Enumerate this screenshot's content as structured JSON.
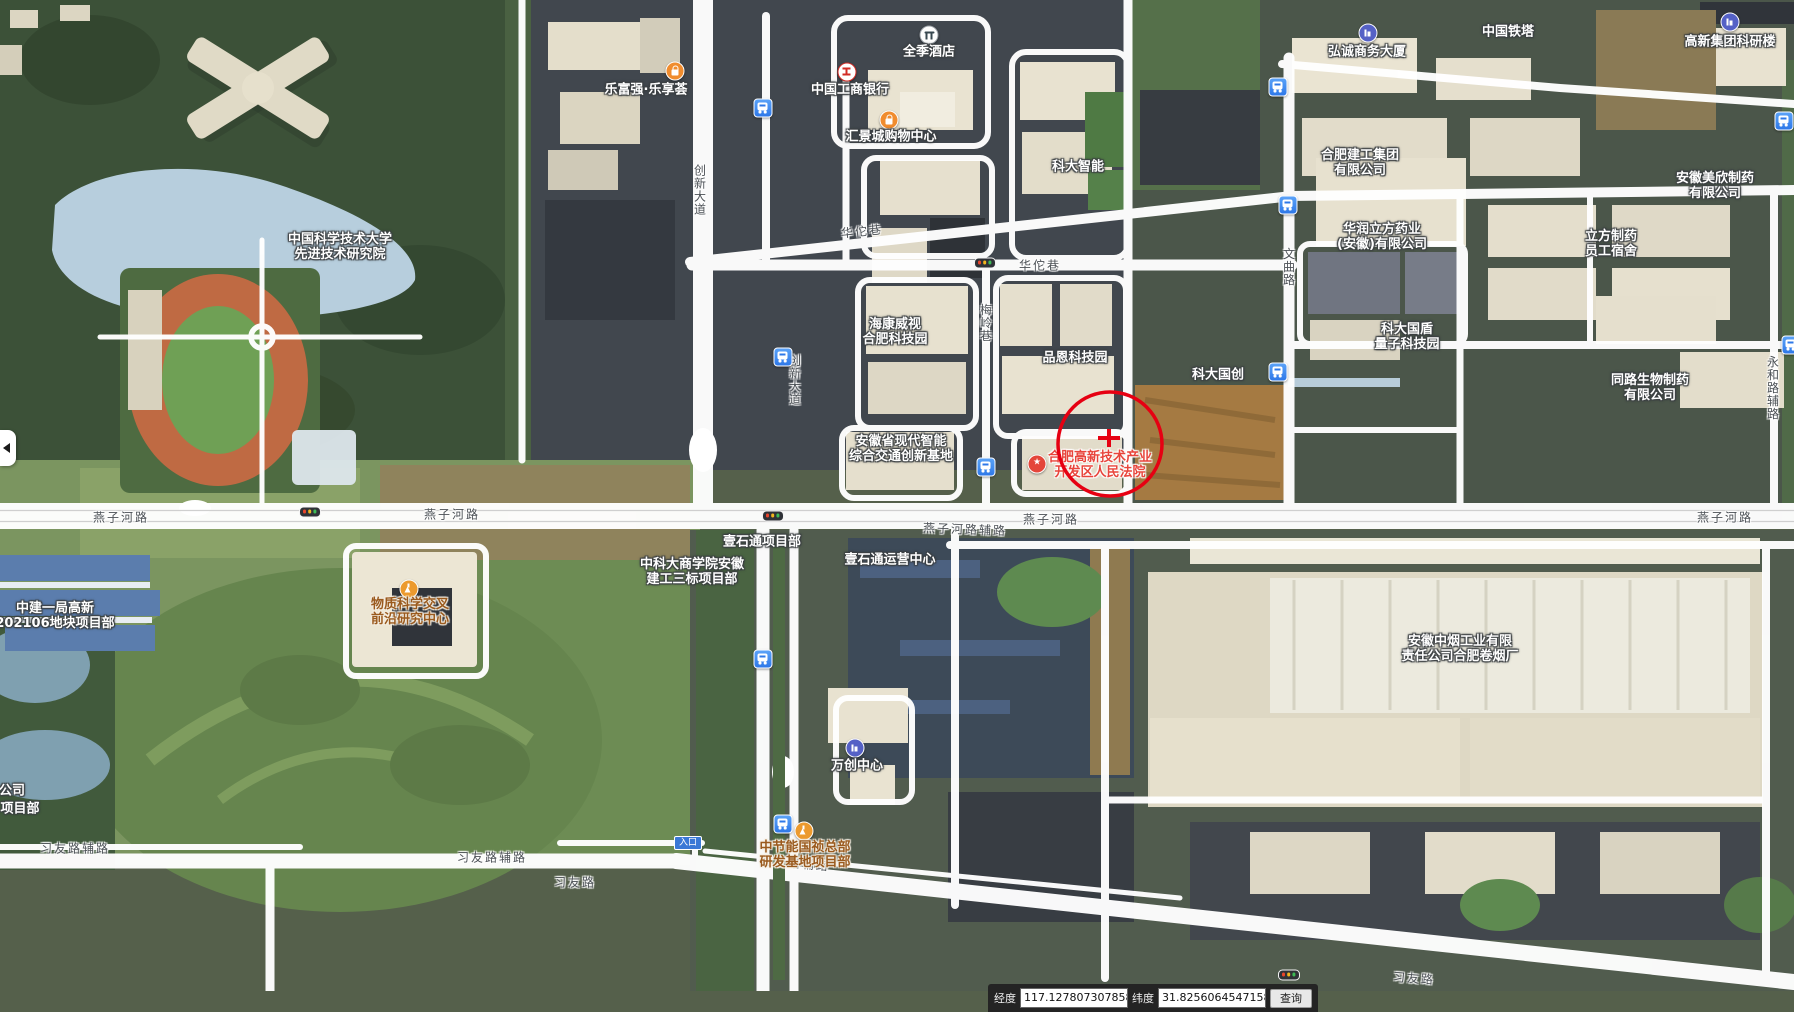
{
  "colors": {
    "road_white": "#ffffff",
    "marker_red": "#e60012",
    "poi_red_text": "#e8453c",
    "poi_brown_text": "#9a5a1e",
    "bus_icon_blue": "#2e78e8",
    "water_blue": "#b7cedd"
  },
  "pois": [
    {
      "l1": "中国科学技术大学",
      "l2": "先进技术研究院",
      "x": 340,
      "y": 247
    },
    {
      "l1": "乐富强·乐享荟",
      "x": 646,
      "y": 90
    },
    {
      "l1": "全季酒店",
      "x": 929,
      "y": 52
    },
    {
      "l1": "中国工商银行",
      "x": 850,
      "y": 90
    },
    {
      "l1": "汇景城购物中心",
      "x": 891,
      "y": 137
    },
    {
      "l1": "科大智能",
      "x": 1078,
      "y": 167
    },
    {
      "l1": "弘诚商务大厦",
      "x": 1367,
      "y": 52
    },
    {
      "l1": "中国铁塔",
      "x": 1508,
      "y": 32
    },
    {
      "l1": "高新集团科研楼",
      "x": 1730,
      "y": 42
    },
    {
      "l1": "合肥建工集团",
      "l2": "有限公司",
      "x": 1360,
      "y": 163
    },
    {
      "l1": "华润立方药业",
      "l2": "(安徽)有限公司",
      "x": 1382,
      "y": 237
    },
    {
      "l1": "安徽美欣制药",
      "l2": "有限公司",
      "x": 1715,
      "y": 186
    },
    {
      "l1": "立方制药",
      "l2": "员工宿舍",
      "x": 1611,
      "y": 244
    },
    {
      "l1": "海康威视",
      "l2": "合肥科技园",
      "x": 895,
      "y": 332
    },
    {
      "l1": "品恩科技园",
      "x": 1075,
      "y": 358
    },
    {
      "l1": "科大国创",
      "x": 1218,
      "y": 375
    },
    {
      "l1": "科大国盾",
      "l2": "量子科技园",
      "x": 1407,
      "y": 337
    },
    {
      "l1": "同路生物制药",
      "l2": "有限公司",
      "x": 1650,
      "y": 388
    },
    {
      "l1": "安徽省现代智能",
      "l2": "综合交通创新基地",
      "x": 901,
      "y": 449
    },
    {
      "l1": "合肥高新技术产业",
      "l2": "开发区人民法院",
      "x": 1100,
      "y": 465,
      "cls": "red"
    },
    {
      "l1": "物质科学交叉",
      "l2": "前沿研究中心",
      "x": 410,
      "y": 612,
      "cls": "brown"
    },
    {
      "l1": "中建一局高新",
      "l2": "202106地块项目部",
      "x": 55,
      "y": 616
    },
    {
      "l1": "中科大商学院安徽",
      "l2": "建工三标项目部",
      "x": 692,
      "y": 572
    },
    {
      "l1": "壹石通项目部",
      "x": 762,
      "y": 542
    },
    {
      "l1": "壹石通运营中心",
      "x": 890,
      "y": 560
    },
    {
      "l1": "万创中心",
      "x": 857,
      "y": 766
    },
    {
      "l1": "中节能国祯总部",
      "l2": "研发基地项目部",
      "x": 805,
      "y": 855,
      "cls": "brown"
    },
    {
      "l1": "安徽中烟工业有限",
      "l2": "责任公司合肥卷烟厂",
      "x": 1460,
      "y": 649
    },
    {
      "l1": "公司",
      "x": 12,
      "y": 791
    },
    {
      "l1": "项目部",
      "x": 20,
      "y": 809
    }
  ],
  "poi_icons": [
    {
      "type": "shopping-bag",
      "x": 675,
      "y": 71
    },
    {
      "type": "hotel",
      "x": 929,
      "y": 35
    },
    {
      "type": "bank",
      "x": 847,
      "y": 72
    },
    {
      "type": "shopping-bag",
      "x": 889,
      "y": 120
    },
    {
      "type": "building",
      "x": 1368,
      "y": 33
    },
    {
      "type": "building",
      "x": 1730,
      "y": 22
    },
    {
      "type": "star",
      "x": 1037,
      "y": 464
    },
    {
      "type": "flask",
      "x": 409,
      "y": 589
    },
    {
      "type": "building",
      "x": 855,
      "y": 748
    },
    {
      "type": "flask",
      "x": 804,
      "y": 831
    }
  ],
  "road_labels": [
    {
      "t": "燕子河路",
      "x": 121,
      "y": 517
    },
    {
      "t": "燕子河路",
      "x": 452,
      "y": 514
    },
    {
      "t": "燕子河路",
      "x": 1051,
      "y": 519
    },
    {
      "t": "燕子河路辅路",
      "x": 965,
      "y": 529,
      "rot": 2
    },
    {
      "t": "燕子河路",
      "x": 1725,
      "y": 517
    },
    {
      "t": "华佗巷",
      "x": 862,
      "y": 231,
      "rot": -6
    },
    {
      "t": "华佗巷",
      "x": 1040,
      "y": 265
    },
    {
      "t": "创新大道",
      "x": 700,
      "y": 190,
      "cls": "vert"
    },
    {
      "t": "创新大道",
      "x": 795,
      "y": 380,
      "cls": "vert"
    },
    {
      "t": "文曲路",
      "x": 1289,
      "y": 267,
      "cls": "vert"
    },
    {
      "t": "梅岭巷",
      "x": 986,
      "y": 323,
      "cls": "vert"
    },
    {
      "t": "永和路辅路",
      "x": 1773,
      "y": 388,
      "cls": "vert"
    },
    {
      "t": "习友路辅路",
      "x": 75,
      "y": 848
    },
    {
      "t": "习友路辅路",
      "x": 492,
      "y": 857
    },
    {
      "t": "习友路",
      "x": 575,
      "y": 882
    },
    {
      "t": "习友路辅路",
      "x": 795,
      "y": 863,
      "rot": 5
    },
    {
      "t": "习友路",
      "x": 1414,
      "y": 978,
      "rot": 4
    }
  ],
  "bus_stops": [
    {
      "x": 763,
      "y": 108
    },
    {
      "x": 1278,
      "y": 87
    },
    {
      "x": 1784,
      "y": 121
    },
    {
      "x": 1288,
      "y": 205
    },
    {
      "x": 783,
      "y": 357
    },
    {
      "x": 986,
      "y": 467
    },
    {
      "x": 1278,
      "y": 372
    },
    {
      "x": 763,
      "y": 659
    },
    {
      "x": 783,
      "y": 824
    },
    {
      "x": 1791,
      "y": 345
    }
  ],
  "traffic_lights": [
    {
      "x": 985,
      "y": 263
    },
    {
      "x": 310,
      "y": 512
    },
    {
      "x": 773,
      "y": 516
    },
    {
      "x": 1289,
      "y": 975
    }
  ],
  "marker": {
    "cx": 1110,
    "cy": 444,
    "r": 52,
    "cross_x": 1109,
    "cross_y": 438,
    "arm": 11,
    "color": "#e60012"
  },
  "entrance": {
    "label": "入口"
  },
  "statusbar": {
    "lon_label": "经度",
    "lon_value": "117.1278073078587",
    "lat_label": "纬度",
    "lat_value": "31.82560645471584",
    "query_label": "查询"
  }
}
